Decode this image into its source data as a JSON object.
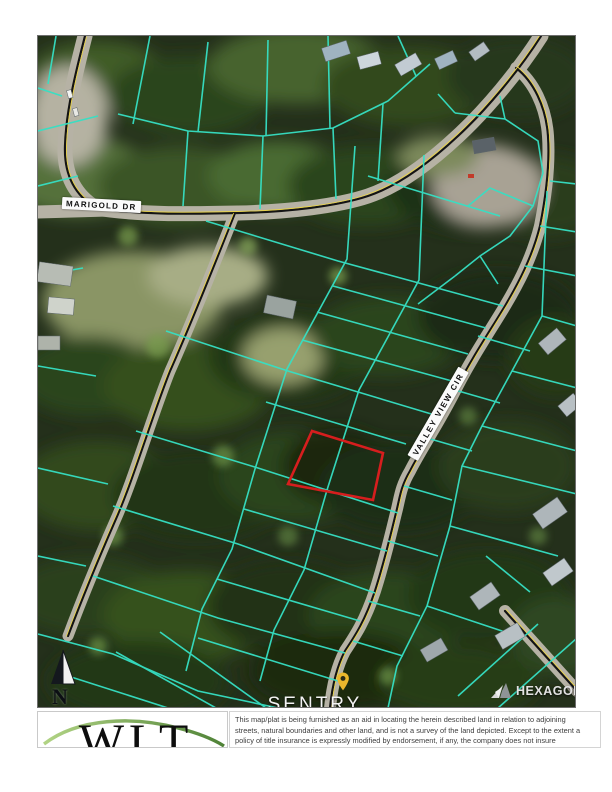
{
  "map": {
    "road_labels": {
      "marigold": "MARIGOLD DR",
      "valley_view": "VALLEY VIEW CIR"
    },
    "north_arrow_label": "N",
    "selected_parcel": {
      "outline_color": "#d61e1e"
    },
    "colors": {
      "parcel_line": "#36e0c4",
      "road_centerline_yellow": "#e8d24a",
      "road_surface": "#b6b2a5",
      "forest_base": "#24301b"
    }
  },
  "branding": {
    "sentry_line1": "SENTRY",
    "sentry_line2": "DYNAMICS",
    "pin_color": "#eab62c",
    "hexagon_label": "HEXAGON"
  },
  "footer": {
    "wlt_logo_text": "WLT",
    "wlt_swoosh_color": "#5a9a2f",
    "disclaimer_lines": [
      "This map/plat is being furnished as an aid in locating the herein described land in relation to adjoining",
      "streets, natural boundaries and other land, and is not a survey of the land depicted. Except to the extent a",
      "policy of title insurance is expressly modified by endorsement, if any, the company does not insure"
    ]
  }
}
